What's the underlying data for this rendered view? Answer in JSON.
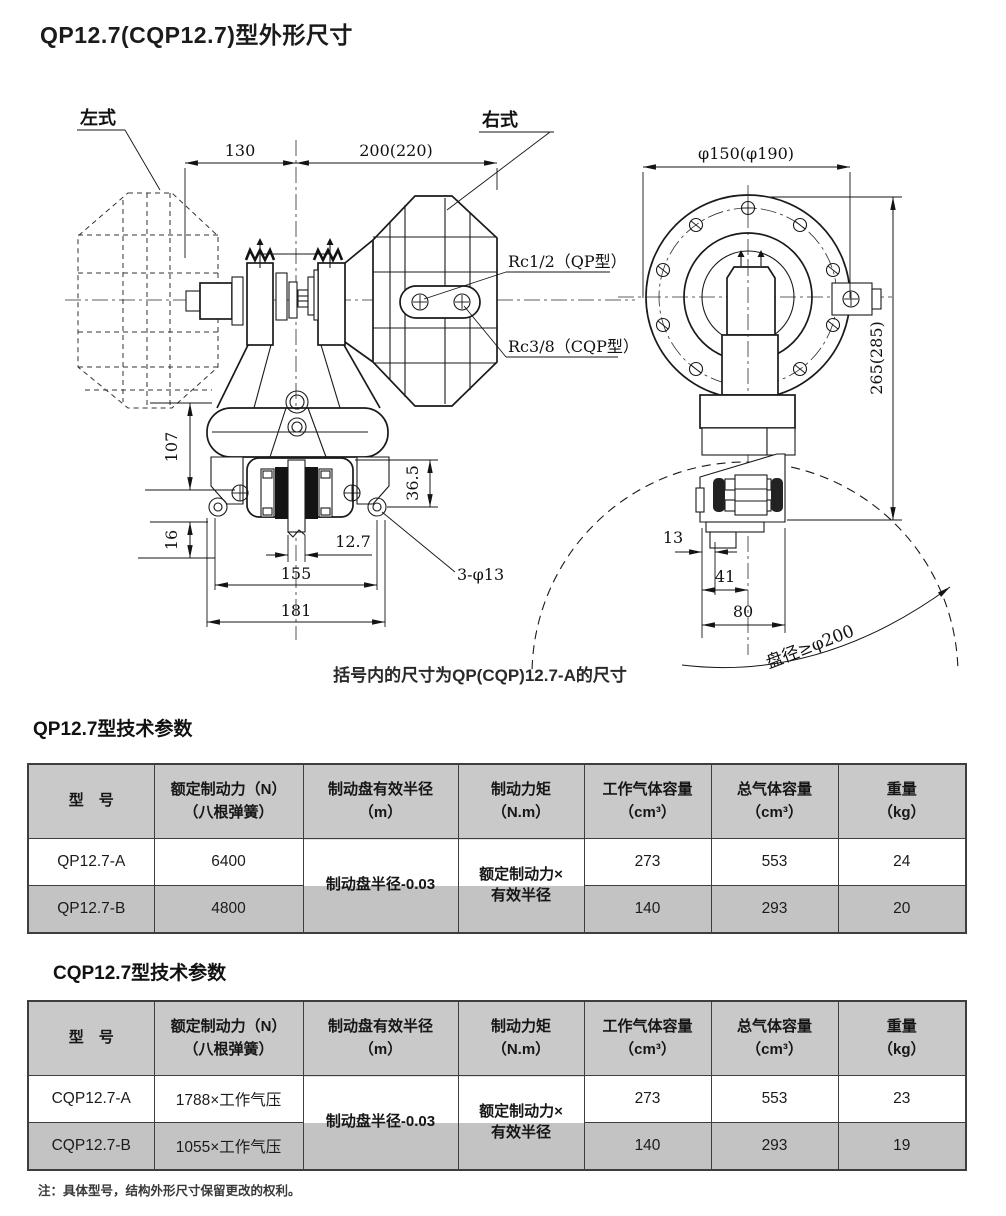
{
  "page": {
    "title": "QP12.7(CQP12.7)型外形尺寸",
    "note": "注：具体型号，结构外形尺寸保留更改的权利。"
  },
  "drawing": {
    "caption": "括号内的尺寸为QP(CQP)12.7-A的尺寸",
    "labels": {
      "left_style": "左式",
      "right_style": "右式",
      "rc_qp": "Rc1/2（QP型）",
      "rc_cqp": "Rc3/8（CQP型）",
      "disc_diameter": "盘径≥φ200",
      "holes": "3-φ13"
    },
    "dims": {
      "w130": "130",
      "w200": "200(220)",
      "phi150": "φ150(φ190)",
      "h265": "265(285)",
      "h107": "107",
      "h16": "16",
      "h365": "36.5",
      "w127": "12.7",
      "w155": "155",
      "w181": "181",
      "w13": "13",
      "w41": "41",
      "w80": "80"
    }
  },
  "tables": {
    "headers": [
      {
        "line1": "型　号",
        "line2": ""
      },
      {
        "line1": "额定制动力（N）",
        "line2": "（八根弹簧）"
      },
      {
        "line1": "制动盘有效半径",
        "line2": "（m）"
      },
      {
        "line1": "制动力矩",
        "line2": "（N.m）"
      },
      {
        "line1": "工作气体容量",
        "line2": "（cm³）"
      },
      {
        "line1": "总气体容量",
        "line2": "（cm³）"
      },
      {
        "line1": "重量",
        "line2": "（kg）"
      }
    ],
    "merged": {
      "radius": "制动盘半径-0.03",
      "torque_line1": "额定制动力×",
      "torque_line2": "有效半径"
    },
    "qp": {
      "title": "QP12.7型技术参数",
      "rows": [
        {
          "model": "QP12.7-A",
          "force": "6400",
          "work_volume": "273",
          "total_volume": "553",
          "weight": "24"
        },
        {
          "model": "QP12.7-B",
          "force": "4800",
          "work_volume": "140",
          "total_volume": "293",
          "weight": "20"
        }
      ]
    },
    "cqp": {
      "title": "CQP12.7型技术参数",
      "rows": [
        {
          "model": "CQP12.7-A",
          "force": "1788×工作气压",
          "work_volume": "273",
          "total_volume": "553",
          "weight": "23"
        },
        {
          "model": "CQP12.7-B",
          "force": "1055×工作气压",
          "work_volume": "140",
          "total_volume": "293",
          "weight": "19"
        }
      ]
    }
  },
  "colors": {
    "header_bg": "#c9c9c9",
    "alt_row_bg": "#c3c3c3",
    "line": "#1a1a1a",
    "border": "#3e3e3e"
  }
}
